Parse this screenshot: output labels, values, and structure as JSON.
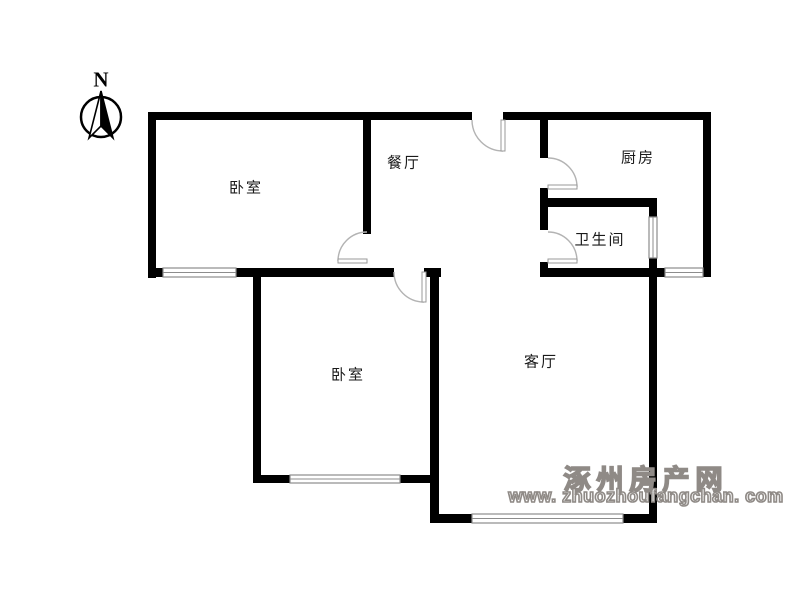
{
  "colors": {
    "background": "#ffffff",
    "wall": "#000000",
    "window_stroke": "#8c8c8c",
    "door_stroke": "#b3b3b3",
    "door_leaf_stroke": "#999999",
    "label_text": "#1a1a1a",
    "watermark": "#8f8a86"
  },
  "compass": {
    "label": "N",
    "cx": 101,
    "cy": 117,
    "r": 20,
    "needle_left": "101,91 89,138 101,126",
    "needle_right": "101,91 113,138 101,126"
  },
  "labels": [
    {
      "id": "bedroom-1",
      "text": "卧室"
    },
    {
      "id": "dining-room",
      "text": "餐厅"
    },
    {
      "id": "kitchen",
      "text": "厨房"
    },
    {
      "id": "bathroom",
      "text": "卫生间"
    },
    {
      "id": "bedroom-2",
      "text": "卧室"
    },
    {
      "id": "living-room",
      "text": "客厅"
    }
  ],
  "watermark": {
    "line1": "涿州房产网",
    "line2": "www. zhuozhoufangchan. com"
  },
  "floorplan": {
    "walls": [
      {
        "x": 148,
        "y": 112,
        "w": 324,
        "h": 8
      },
      {
        "x": 503,
        "y": 112,
        "w": 208,
        "h": 8
      },
      {
        "x": 148,
        "y": 112,
        "w": 8,
        "h": 166
      },
      {
        "x": 363,
        "y": 112,
        "w": 8,
        "h": 122
      },
      {
        "x": 148,
        "y": 268,
        "w": 15,
        "h": 9
      },
      {
        "x": 236,
        "y": 268,
        "w": 158,
        "h": 9
      },
      {
        "x": 424,
        "y": 268,
        "w": 17,
        "h": 9
      },
      {
        "x": 253,
        "y": 270,
        "w": 8,
        "h": 213
      },
      {
        "x": 253,
        "y": 475,
        "w": 37,
        "h": 8
      },
      {
        "x": 400,
        "y": 475,
        "w": 37,
        "h": 8
      },
      {
        "x": 430,
        "y": 270,
        "w": 9,
        "h": 253
      },
      {
        "x": 430,
        "y": 514,
        "w": 42,
        "h": 9
      },
      {
        "x": 623,
        "y": 514,
        "w": 34,
        "h": 9
      },
      {
        "x": 649,
        "y": 198,
        "w": 8,
        "h": 19
      },
      {
        "x": 649,
        "y": 258,
        "w": 8,
        "h": 265
      },
      {
        "x": 540,
        "y": 112,
        "w": 8,
        "h": 46
      },
      {
        "x": 540,
        "y": 188,
        "w": 8,
        "h": 42
      },
      {
        "x": 540,
        "y": 262,
        "w": 8,
        "h": 15
      },
      {
        "x": 540,
        "y": 198,
        "w": 117,
        "h": 9
      },
      {
        "x": 540,
        "y": 268,
        "w": 125,
        "h": 9
      },
      {
        "x": 703,
        "y": 112,
        "w": 8,
        "h": 165
      }
    ],
    "windows": [
      {
        "x": 163,
        "y": 268,
        "w": 73,
        "h": 9
      },
      {
        "x": 290,
        "y": 475,
        "w": 110,
        "h": 8
      },
      {
        "x": 472,
        "y": 514,
        "w": 151,
        "h": 9
      },
      {
        "x": 665,
        "y": 268,
        "w": 38,
        "h": 9
      },
      {
        "x": 649,
        "y": 217,
        "w": 8,
        "h": 41
      }
    ],
    "doors": [
      {
        "name": "entrance-door",
        "leaf": {
          "x": 501,
          "y": 120,
          "w": 4,
          "h": 31
        },
        "arc": "M 472 120 A 31 31 0 0 0 503 151"
      },
      {
        "name": "bedroom-1-door",
        "leaf": {
          "x": 338,
          "y": 259,
          "w": 29,
          "h": 4
        },
        "arc": "M 338 261 A 29 29 0 0 1 367 232"
      },
      {
        "name": "bedroom-2-door",
        "leaf": {
          "x": 422,
          "y": 272,
          "w": 4,
          "h": 30
        },
        "arc": "M 394 272 A 30 30 0 0 0 424 302"
      },
      {
        "name": "kitchen-door",
        "leaf": {
          "x": 548,
          "y": 185,
          "w": 29,
          "h": 4
        },
        "arc": "M 548 158 A 29 29 0 0 1 577 187"
      },
      {
        "name": "bathroom-door",
        "leaf": {
          "x": 548,
          "y": 259,
          "w": 29,
          "h": 4
        },
        "arc": "M 548 232 A 29 29 0 0 1 577 261"
      }
    ]
  }
}
